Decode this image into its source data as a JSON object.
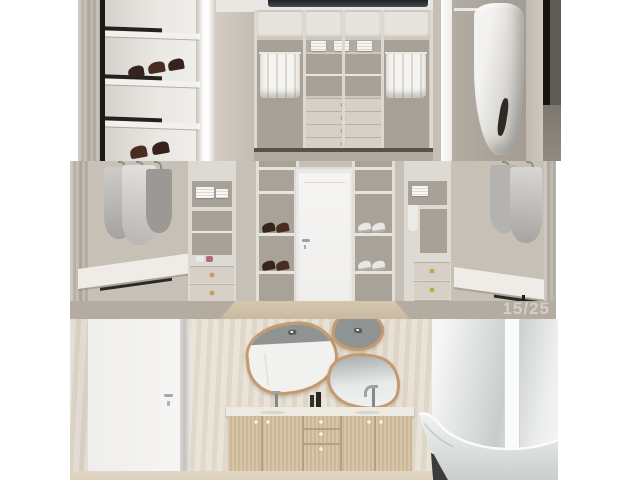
{
  "viewer": {
    "counter": "15/25"
  },
  "collage": {
    "photos": [
      {
        "name": "walk-in-closet-shelving-view"
      },
      {
        "name": "walk-in-closet-door-view"
      },
      {
        "name": "bathroom-vanity-bathtub-view"
      }
    ]
  },
  "colors": {
    "bg": "#ffffff",
    "wall-greige": "#c7c0b6",
    "wall-dark-greige": "#a8a198",
    "marble-cream": "#e8e0d3",
    "shelf-white": "#f3f1ed",
    "drawer-face": "#d7d0c6",
    "knob-gold": "#c9a54a",
    "black-trim": "#1c1a17",
    "door-white": "#f5f4f2",
    "vanity-wood": "#d3c0a4",
    "mirror-frame": "#c49a6e",
    "reflection-gray": "#8f9493",
    "dark-panel": "#5f5c56",
    "watermark": "rgba(255,255,255,0.42)"
  }
}
